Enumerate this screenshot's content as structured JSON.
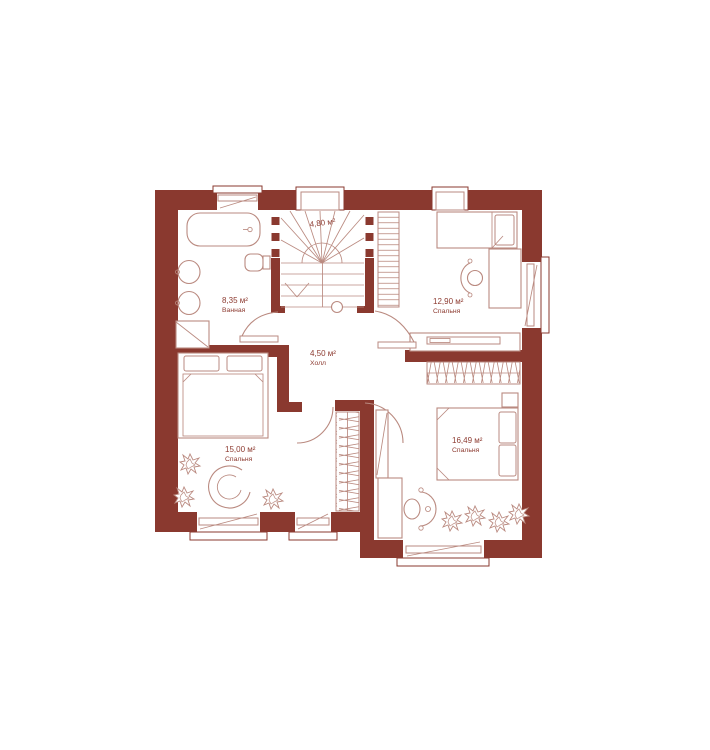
{
  "page": {
    "background": "#FFFFFF"
  },
  "plan": {
    "type": "floor-plan",
    "floor": "second-floor-apartment-plan",
    "language": "ru",
    "colors": {
      "wall": "#8A392F",
      "furniture_line": "#BA8A80",
      "label_text": "#8D3B31",
      "background": "#FFFFFF"
    },
    "rooms": [
      {
        "id": "bathroom",
        "area_label": "8,35 м²",
        "name": "Ванная"
      },
      {
        "id": "stairs",
        "area_label": "4,80 м²",
        "name": ""
      },
      {
        "id": "bedroom-top-right",
        "area_label": "12,90 м²",
        "name": "Спальня"
      },
      {
        "id": "hall",
        "area_label": "4,50 м²",
        "name": "Холл"
      },
      {
        "id": "bedroom-bottom-left",
        "area_label": "15,00 м²",
        "name": "Спальня"
      },
      {
        "id": "bedroom-bottom-right",
        "area_label": "16,49 м²",
        "name": "Спальня"
      }
    ]
  }
}
